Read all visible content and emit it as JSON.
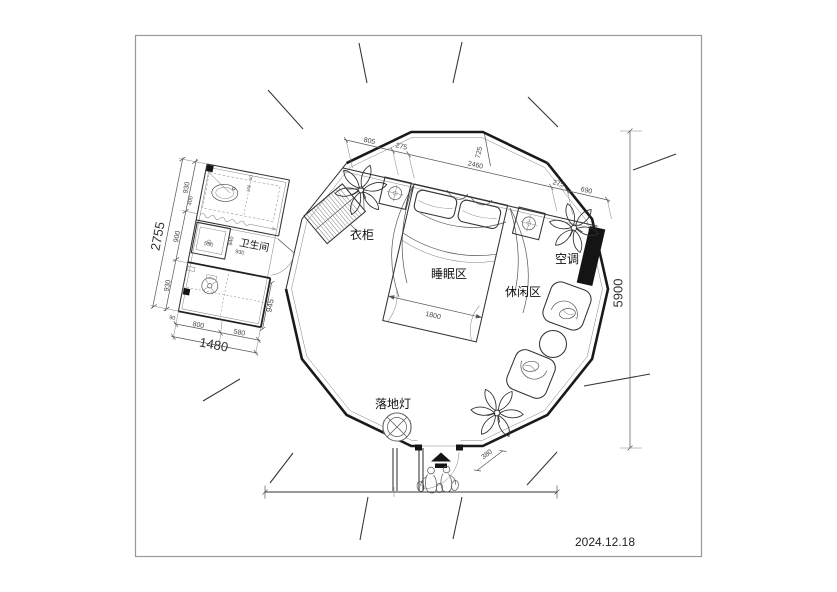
{
  "page": {
    "date": "2024.12.18"
  },
  "labels": {
    "bathroom": "卫生间",
    "wardrobe": "衣柜",
    "sleeping_area": "睡眠区",
    "leisure_area": "休闲区",
    "air_conditioner": "空调",
    "floor_lamp": "落地灯"
  },
  "dims": {
    "overall_height": "5900",
    "bath_left_total": "2755",
    "bath_left_top": "930",
    "bath_left_mid": "900",
    "bath_left_bottom": "930",
    "bath_bottom_left": "800",
    "bath_bottom_right": "580",
    "bath_bottom_total": "1480",
    "bath_bottom_small": "90",
    "bath_right": "945",
    "shower": "550",
    "bath_inner_v": "940",
    "bath_inner_h": "930",
    "bath_inner_left": "400",
    "bath_tiny_a": "150",
    "bath_tiny_b": "50",
    "top_a": "805",
    "top_b": "275",
    "top_span": "2460",
    "top_offset": "725",
    "top_c": "275",
    "top_d": "690",
    "bed_width": "1800",
    "door_side": "380"
  },
  "icons": {
    "entry_arrow": "entry-direction-arrow",
    "lamp_symbol": "floor-lamp-symbol",
    "fan_symbol": "exhaust-fan-symbol"
  },
  "colors": {
    "wall": "#1a1a1a",
    "line": "#333333",
    "dim": "#555555",
    "solid_fill": "#141414",
    "frame": "#999999"
  }
}
